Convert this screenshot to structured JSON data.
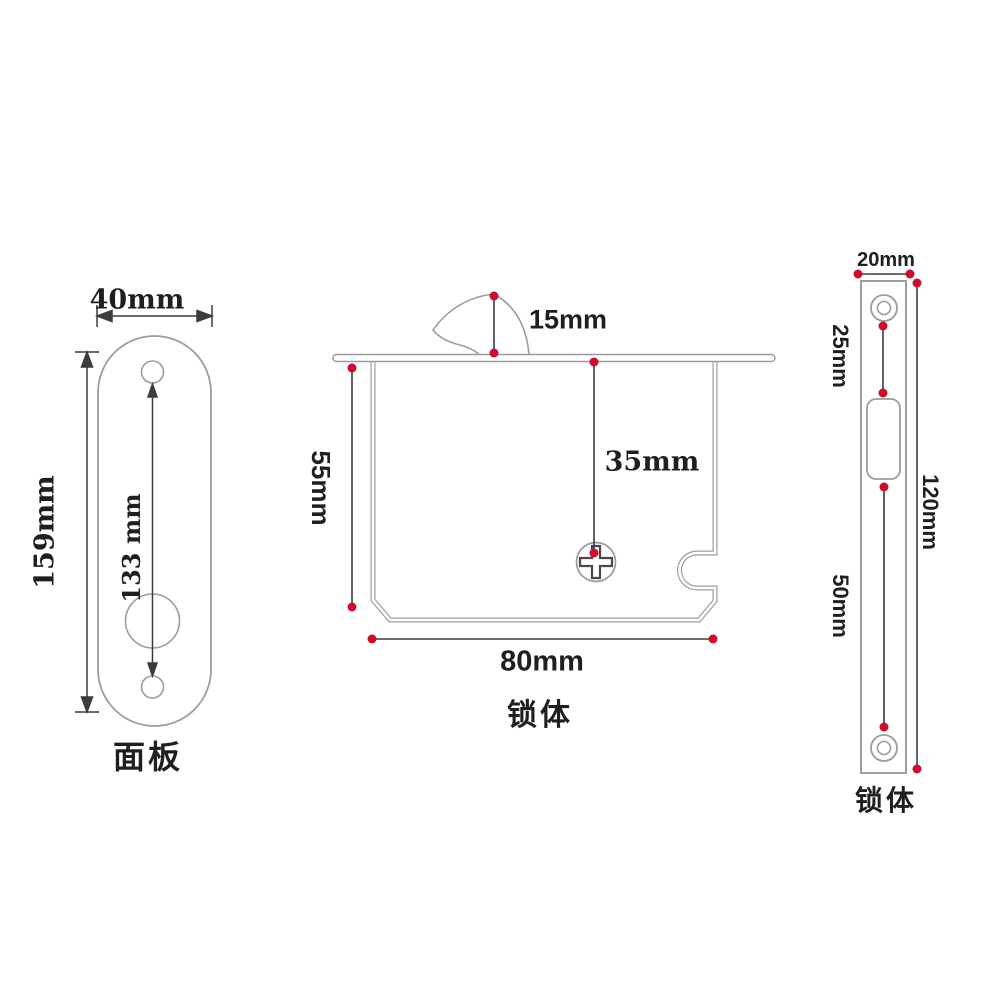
{
  "faceplate": {
    "label": "面板",
    "width": "40mm",
    "height": "159mm",
    "hole_spacing": "133 mm"
  },
  "lock_body": {
    "label": "锁体",
    "hook_height": "15mm",
    "body_height": "55mm",
    "screw_offset": "35mm",
    "body_width": "80mm"
  },
  "strike_plate": {
    "label": "锁体",
    "width": "20mm",
    "top_section": "25mm",
    "total_height": "120mm",
    "bottom_section": "50mm"
  },
  "colors": {
    "part_outline": "#9c9c9c",
    "dimension_line": "#3c3c3c",
    "marker_dot": "#c8102e",
    "text": "#1f1f1f",
    "background": "#ffffff"
  }
}
